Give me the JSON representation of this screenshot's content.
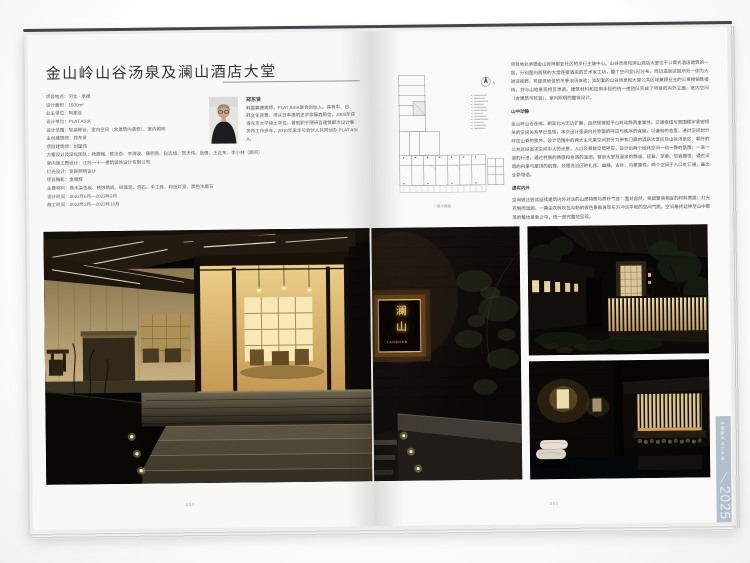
{
  "colors": {
    "page": "#f8f8f7",
    "edge_tab": "#b3bfc9",
    "sign_glow": "#f4cf88",
    "photo_warm_light": "#e9c87e"
  },
  "left_page": {
    "title": "金山岭山谷汤泉及澜山酒店大堂",
    "info_lines": [
      "项目地点：河北 · 承德",
      "设计面积：1500m²",
      "业主单位：阿那亚",
      "设计单位：PLAT ASIA",
      "设计范围：软装陈设、室内空间（含建筑内装修）、室内照明",
      "主创建筑师：郑东贤",
      "项目建筑师：刘国伟",
      "方案设计及深化团队：杨霞梅、陈志奇、李海波、康明亮、赵志旭、贺天伟、张倩、王正东、李小林（顾问）",
      "室内施工图设计：江苏一十一建筑装饰设计有限公司",
      "灯光设计：宽颜照明设计",
      "项目摄影：金啸辉",
      "主要材料：橡木染色板、锈蚀钢板、硅藻泥、洞石、手工砖、和纸灯笼、黑色水磨石",
      "设计时间：2022年6月—2023年2月",
      "施工时间：2023年2月—2023年10月"
    ],
    "architect": {
      "name": "郑东贤",
      "bio": "韩国籍建筑师，PLAT ASIA联合创始人。具有中、日、韩文化背景，师从日本建筑史学家藤森照信，2005年获得东京大学硕士学位，曾就职于隈研吾建筑都市设计事务所工作多年，2010年来华与合伙人共同创办 PLAT ASIA。"
    },
    "page_number": "034",
    "photo_subject": "hotel-lobby-entrance-at-night"
  },
  "right_page": {
    "plan_caption": "一层平面图",
    "north_label": "N",
    "intro": "项目地处承德金山岭阿那亚社区的步行主轴中心。山谷汤泉和澜山酒店大堂位于公寓式酒店建筑的一层，分别面向两侧的大堂连接酒店的艺术家工坊，整个空间呈L形分布。西边温泉区因所处一侧为大进深视野，可提供绝佳的冬季泡汤体验；其配套的山谷汤泉和大堂公共区域兼顾业主的公寓楼销售接待，并与山地景观相互渗透。建筑材料和应用手段的统一使团队完成了项目的内外立面、室内空间（含建筑与软装）、室内照明的整体设计。",
    "sections": [
      {
        "heading": "山中动静",
        "text": "金山岭山谷连绵，朝其北方无边扩展，自然规律赋予山岭动静两重属性。交通枢纽与周围楼宇紧密相关的空间关系早已显现，本次设计强调内外界面的呼应与秩序的保留，以谦和的态度，通过空间划分呼应山脊的秩序。设计范围中的两大主元素空间划分为带有门廊的酒店大堂区及山谷汤泉区：朝外的公共区域追求空间中人的光景，入口及景致交错呼应，设计出两个经纬空间一动一静的氛围；一进一退的行进，通过材质的质感和色调的温润，营造大堂及温泉的静谧、轻盈、至柔、包容属性；通过深暗的内里与屋顶的肌理，处理洗浴区的礼序、幽静、古朴、内聚属性。两个空间于入口处汇通，画出全新物语。"
      },
      {
        "heading": "虚实内外",
        "text": "空间做法尝试延续建筑内外对话的山居特质与质朴气息：面对自然，保留繁简相宜的材料质感；灯光克制而温润，一幕由灰砖灰瓦勾勒的夜色景象再现东方冲淡平和的空间气质。空间最终延伸至山中聚落的整体意象之中，统一而完整地呈现。"
      }
    ],
    "sign": {
      "cn": "澜山",
      "en": "LANSHAN"
    },
    "page_number": "035",
    "edge_tab": {
      "series": "中国室内设计年鉴",
      "year": "2025"
    },
    "photo_subjects": [
      "lanshan-brick-wall-sign",
      "night-exterior-slat-fence",
      "spa-interior-towels"
    ]
  }
}
